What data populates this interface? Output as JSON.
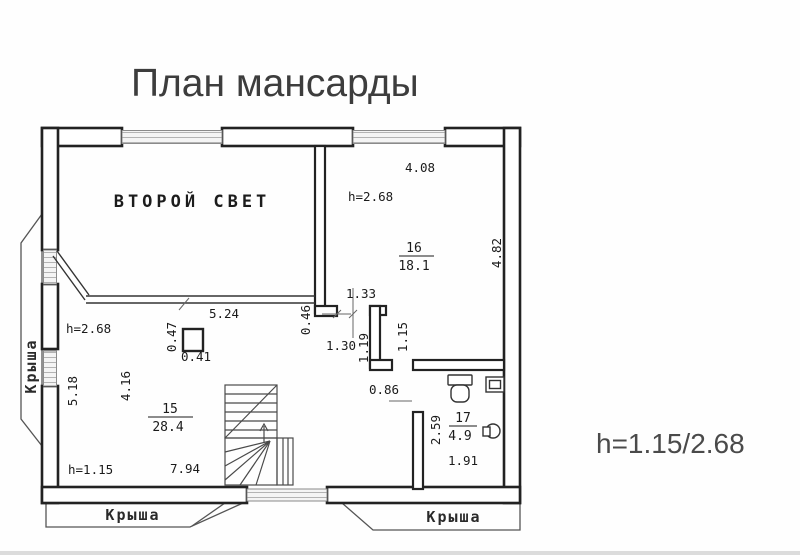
{
  "title": "План мансарды",
  "note": "h=1.15/2.68",
  "labels": {
    "second_light": "ВТОРОЙ СВЕТ",
    "roof": "Крыша"
  },
  "rooms": [
    {
      "number": "16",
      "area": "18.1"
    },
    {
      "number": "15",
      "area": "28.4"
    },
    {
      "number": "17",
      "area": "4.9"
    }
  ],
  "dims": {
    "top_width": "4.08",
    "right_depth": "4.82",
    "h_upper": "h=2.68",
    "h_lower": "h=1.15",
    "partition_width": "5.24",
    "opening_rough": "1.33",
    "opening_clear": "1.30",
    "step_depth": "0.46",
    "jamb": "1.19",
    "pier": "1.15",
    "chimney_h": "0.47",
    "chimney_w": "0.41",
    "left_depth": "5.18",
    "inner_depth": "4.16",
    "bath_door": "0.86",
    "bath_depth": "2.59",
    "bath_width": "1.91",
    "room15_width": "7.94"
  }
}
